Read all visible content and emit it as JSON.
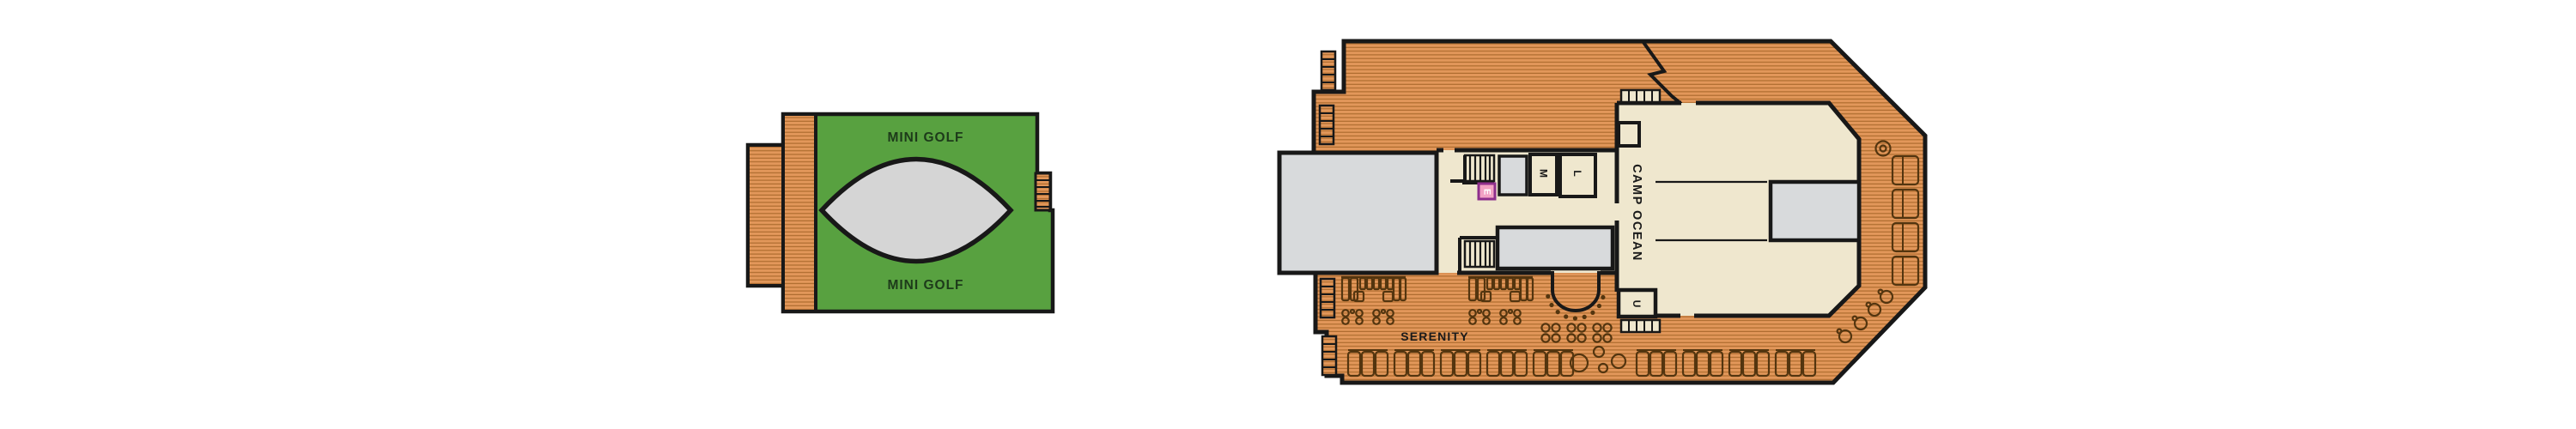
{
  "page": {
    "type": "cruise-ship-deck-plan",
    "sections": [
      "mini-golf-deck",
      "serenity-camp-ocean-deck"
    ]
  },
  "mini_golf": {
    "label_top": "MINI GOLF",
    "label_bottom": "MINI GOLF"
  },
  "main_deck": {
    "serenity_label": "SERENITY",
    "camp_ocean_label": "CAMP OCEAN",
    "room_m_label": "M",
    "room_l_label": "L",
    "room_u_label": "U",
    "elevator_label": "E"
  },
  "colors": {
    "wood": "#E2975A",
    "wood_stripe": "#AE6C2F",
    "outline": "#181818",
    "green": "#58A140",
    "green_text": "#1D3A1A",
    "cream": "#EFE7CE",
    "gray": "#D8DADC",
    "eye_gray": "#D5D5D5",
    "furniture": "#53350F",
    "elevator_fill": "#F2A2C4",
    "elevator_border": "#8E2E8C",
    "elevator_text": "#FFFFFF",
    "text_dark": "#1A1A1A"
  }
}
